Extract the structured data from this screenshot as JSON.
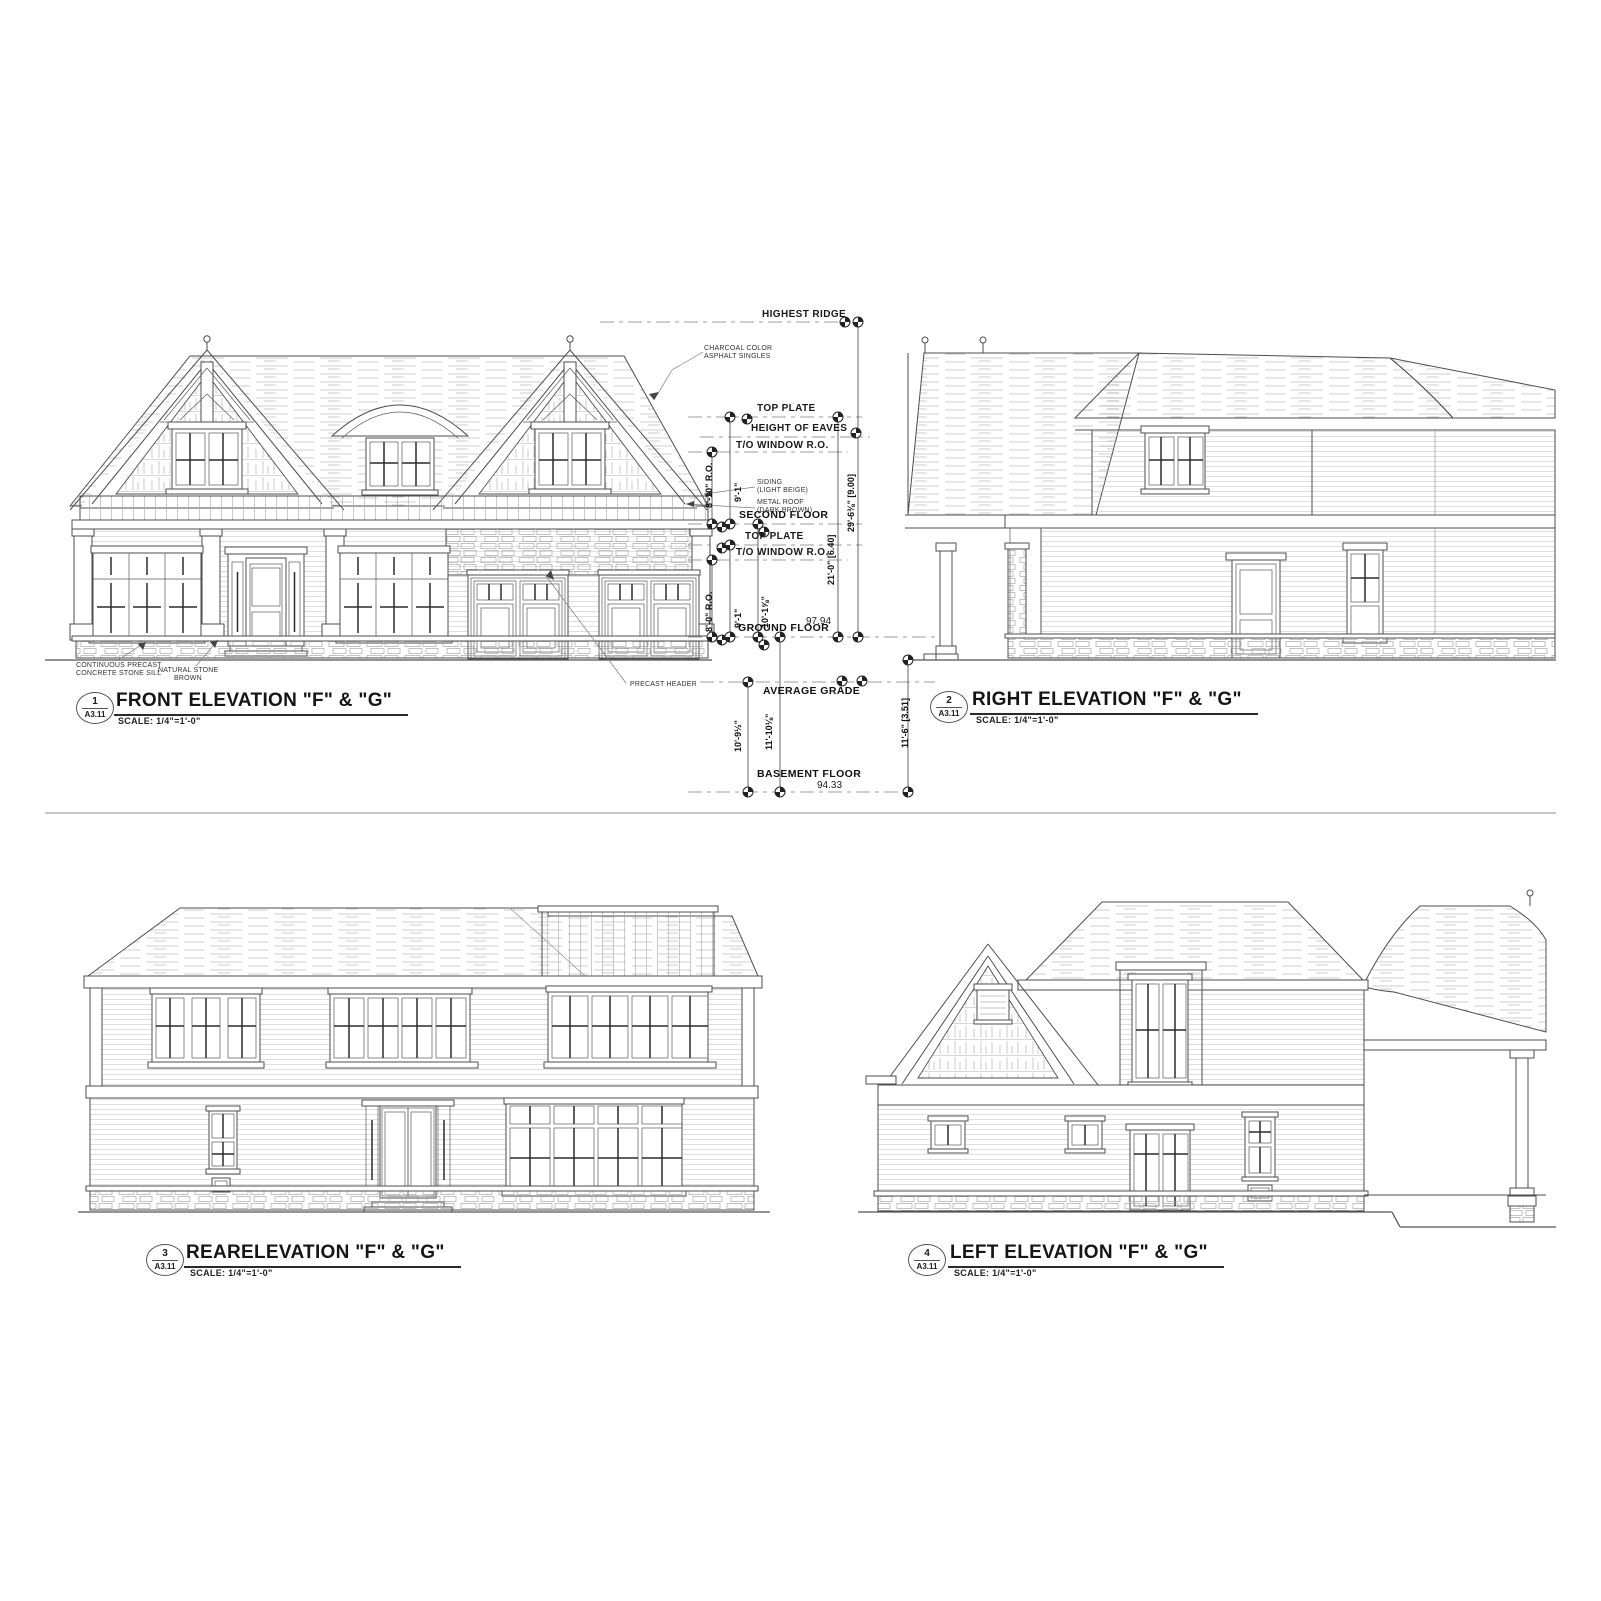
{
  "sheet": {
    "background": "#ffffff",
    "line_color": "#4d4d4d"
  },
  "views": [
    {
      "num": "1",
      "sheet_no": "A3.11",
      "title": "FRONT ELEVATION \"F\" & \"G\"",
      "scale": "SCALE:  1/4\"=1'-0\""
    },
    {
      "num": "2",
      "sheet_no": "A3.11",
      "title": "RIGHT ELEVATION \"F\" & \"G\"",
      "scale": "SCALE:  1/4\"=1'-0\""
    },
    {
      "num": "3",
      "sheet_no": "A3.11",
      "title": "REARELEVATION \"F\" & \"G\"",
      "scale": "SCALE:  1/4\"=1'-0\""
    },
    {
      "num": "4",
      "sheet_no": "A3.11",
      "title": "LEFT ELEVATION \"F\" & \"G\"",
      "scale": "SCALE:  1/4\"=1'-0\""
    }
  ],
  "levels": {
    "highest_ridge": "HIGHEST RIDGE",
    "top_plate_upper": "TOP PLATE",
    "height_of_eaves": "HEIGHT OF EAVES",
    "to_window_ro_upper": "T/O WINDOW R.O.",
    "second_floor": "SECOND FLOOR",
    "top_plate_main": "TOP PLATE",
    "to_window_ro_main": "T/O WINDOW R.O.",
    "ground_floor": "GROUND FLOOR",
    "ground_floor_elevation": "97.94",
    "average_grade": "AVERAGE GRADE",
    "basement_floor": "BASEMENT FLOOR",
    "basement_floor_elevation": "94.33"
  },
  "dimensions": {
    "ridge_above_ground": "29'-6⅜\" [9.00]",
    "plate_above_ground": "21'-0\" [6.40]",
    "grade_to_basement_right": "11'-6\" [3.51]",
    "window_upper_height": "9'-1\"",
    "window_upper_ro": "8'-10\" R.O.",
    "window_main_height": "9'-1\"",
    "window_main_ro": "8'-0\" R.O.",
    "ground_to_second": "10'-1⅝\"",
    "grade_to_basement": "10'-9½\"",
    "ground_to_basement": "11'-10⅛\""
  },
  "notes": {
    "roof_note_1": "CHARCOAL COLOR",
    "roof_note_2": "ASPHALT SINGLES",
    "siding_note_1": "SIDING",
    "siding_note_2": "(LIGHT BEIGE)",
    "metal_roof_note_1": "METAL ROOF",
    "metal_roof_note_2": "(DARK BROWN)",
    "sill_note_1": "CONTINUOUS PRECAST",
    "sill_note_2": "CONCRETE STONE SILL",
    "stone_note_1": "NATURAL STONE",
    "stone_note_2": "BROWN",
    "header_note": "PRECAST HEADER"
  }
}
